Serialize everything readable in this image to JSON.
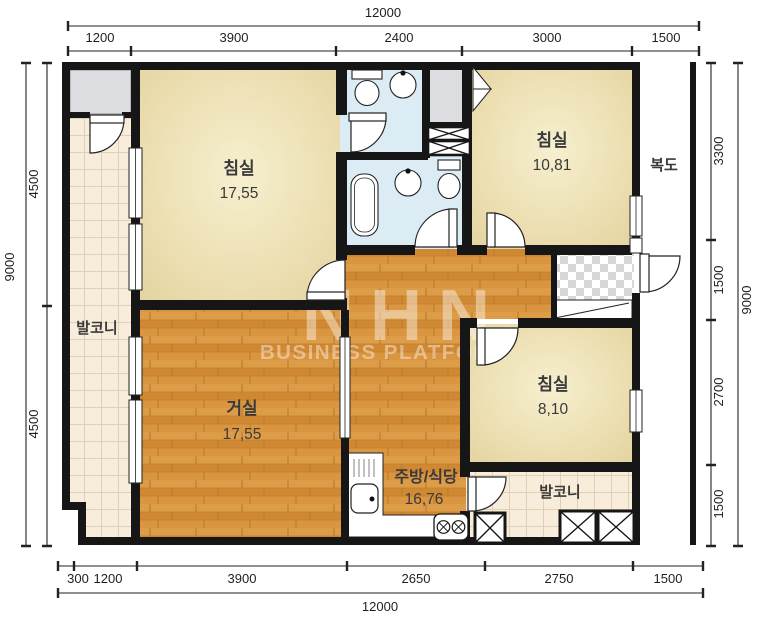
{
  "plan": {
    "rooms": {
      "bedroom_top_left": {
        "label": "침실",
        "area": "17,55"
      },
      "bedroom_top_right": {
        "label": "침실",
        "area": "10,81"
      },
      "bedroom_right": {
        "label": "침실",
        "area": "8,10"
      },
      "living_room": {
        "label": "거실",
        "area": "17,55"
      },
      "kitchen_dining": {
        "label": "주방/식당",
        "area": "16,76"
      },
      "balcony_left": {
        "label": "발코니"
      },
      "balcony_bottom": {
        "label": "발코니"
      },
      "corridor": {
        "label": "복도"
      }
    },
    "dimensions_mm": {
      "top": {
        "total": "12000",
        "segments": [
          "1200",
          "3900",
          "2400",
          "3000",
          "1500"
        ]
      },
      "bottom": {
        "total": "12000",
        "segments": [
          "300",
          "1200",
          "3900",
          "2650",
          "2750",
          "1500"
        ]
      },
      "left": {
        "total": "9000",
        "segments": [
          "4500",
          "4500"
        ]
      },
      "right": {
        "total": "9000",
        "segments": [
          "3300",
          "1500",
          "2700",
          "1500"
        ]
      }
    },
    "watermark": {
      "logo": "NHN",
      "text": "BUSINESS PLATFORM"
    },
    "colors": {
      "wall": "#161616",
      "wood_floor": "#d6923c",
      "tile_floor": "#f8edda",
      "bathroom": "#dcecf4",
      "room_beige": "#ecdfb2",
      "closet_gray": "#dcdde0",
      "background": "#ffffff"
    }
  }
}
